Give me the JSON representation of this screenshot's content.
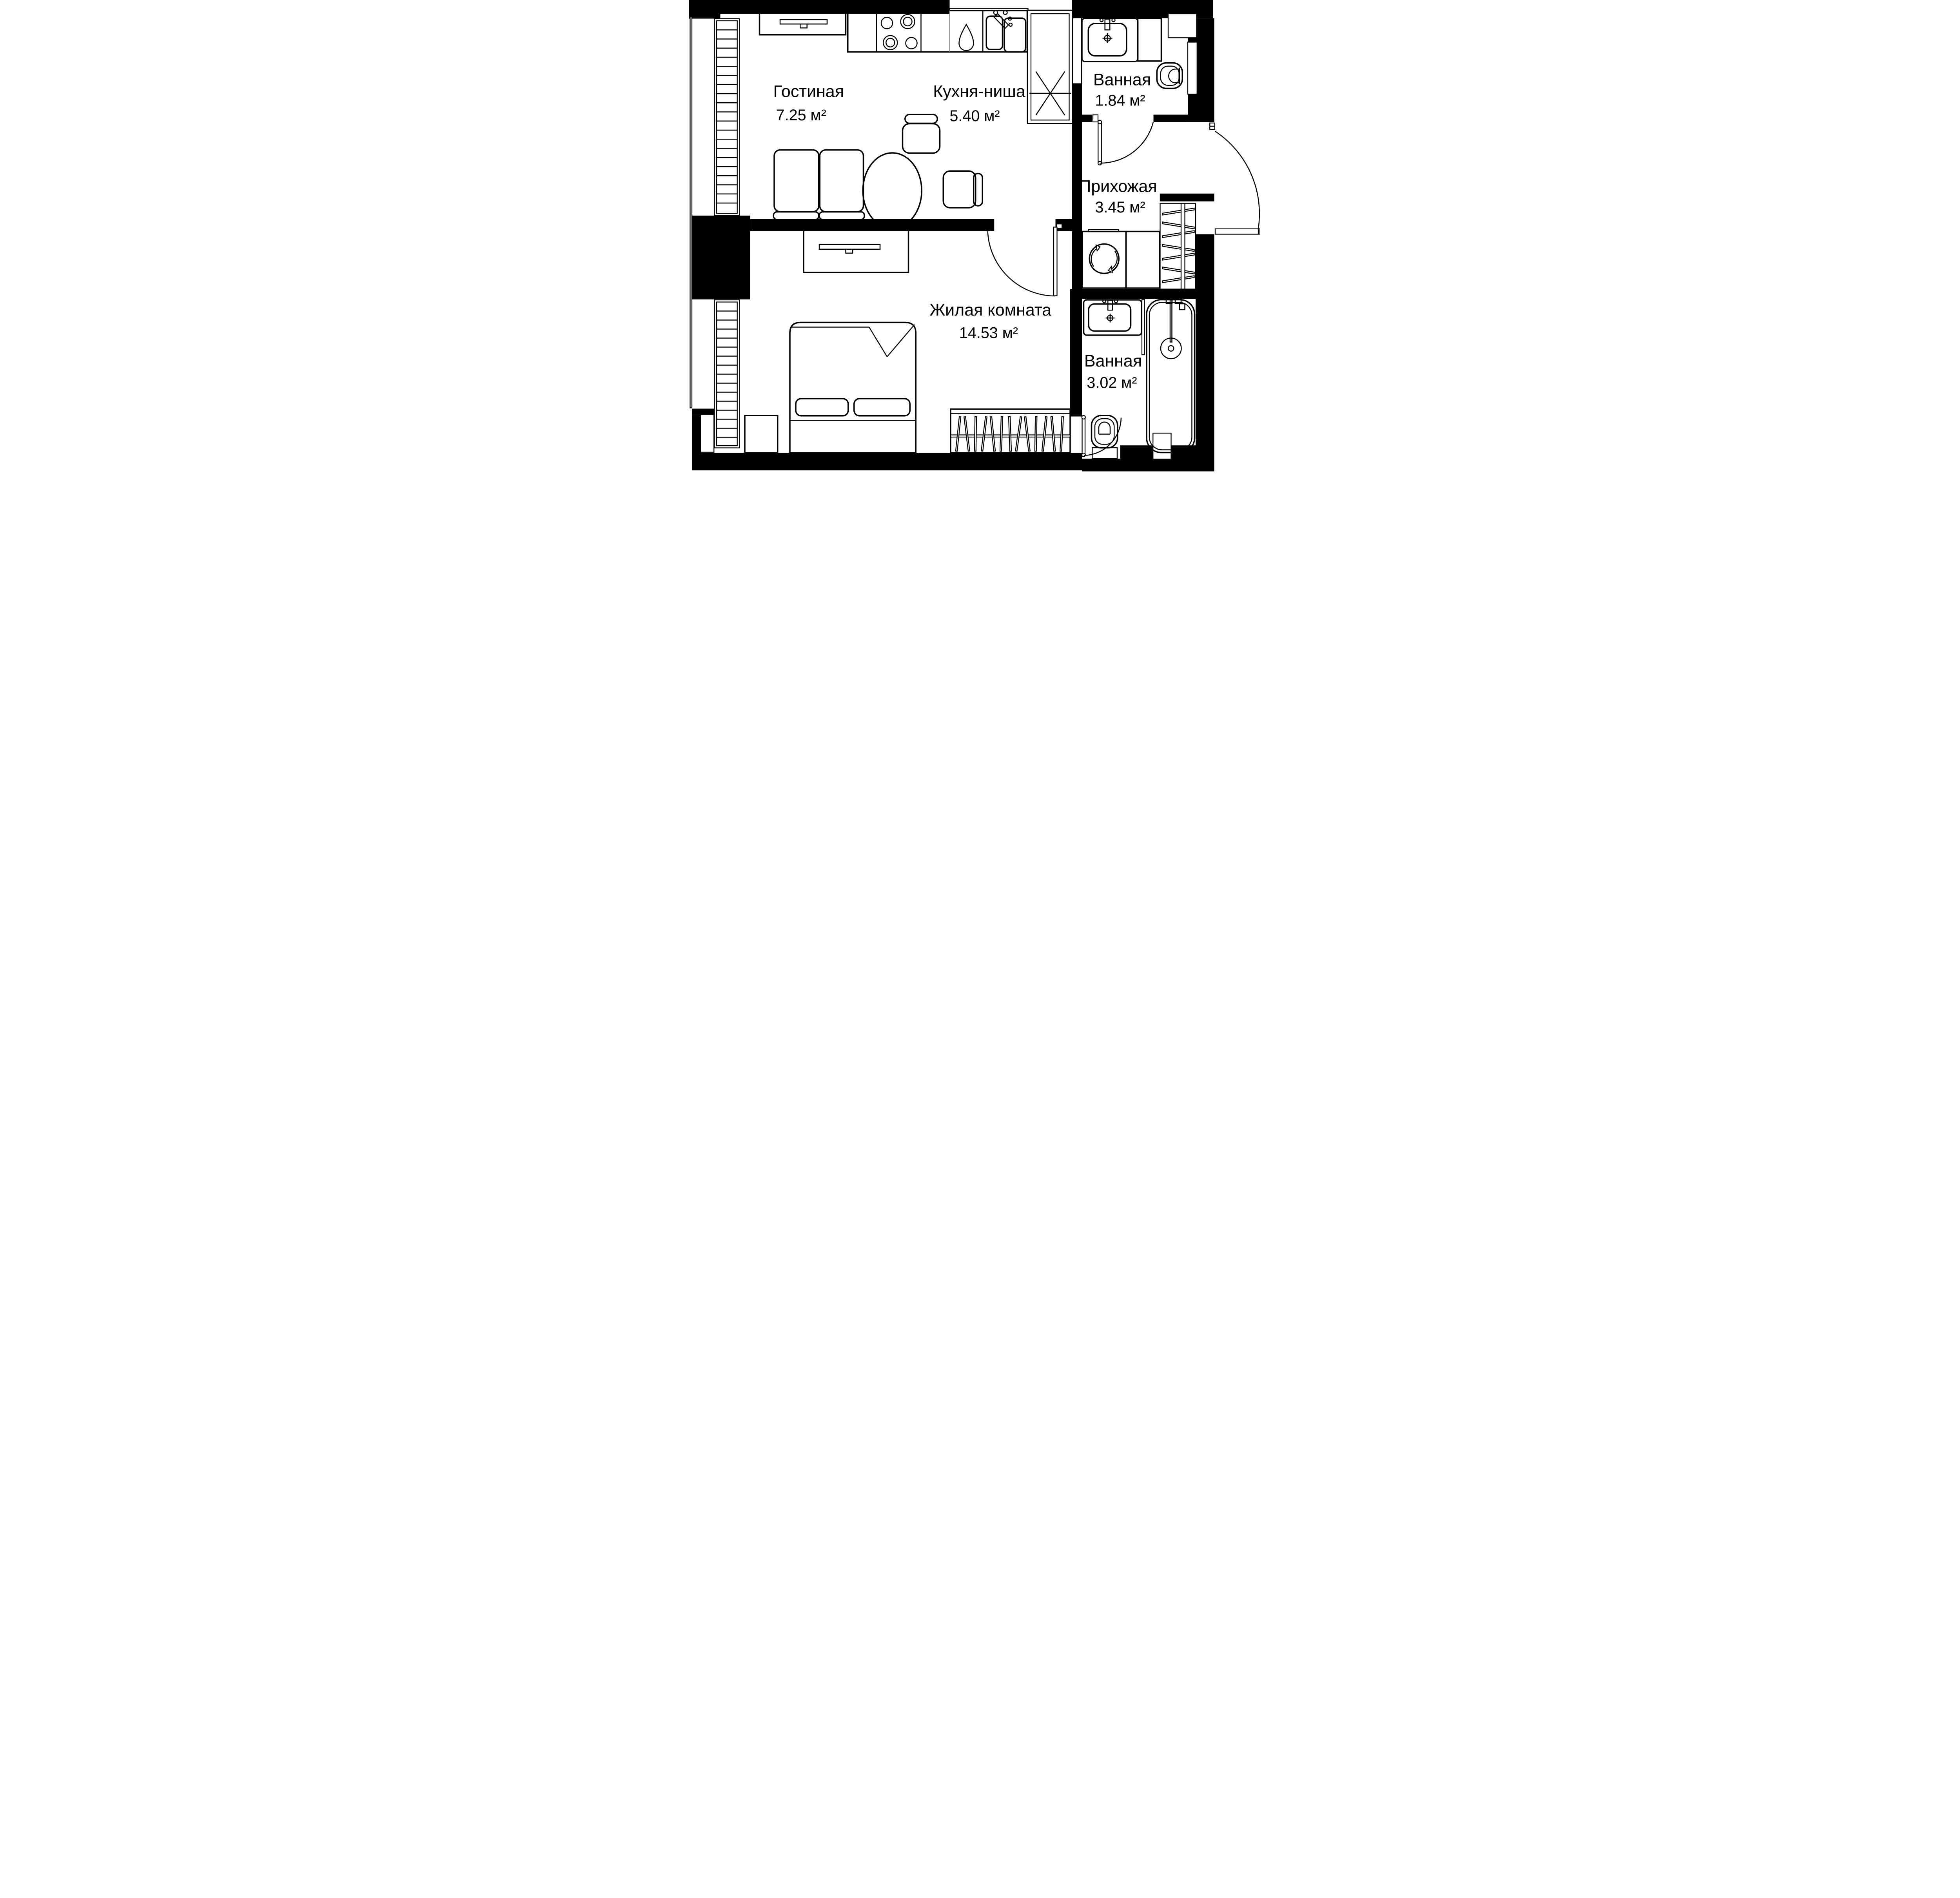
{
  "plan": {
    "title": "Apartment floor plan",
    "rooms": [
      {
        "name": "Гостиная",
        "area": "7.25 м²"
      },
      {
        "name": "Кухня-ниша",
        "area": "5.40 м²"
      },
      {
        "name": "Ванная",
        "area": "1.84 м²"
      },
      {
        "name": "Прихожая",
        "area": "3.45 м²"
      },
      {
        "name": "Жилая комната",
        "area": "14.53 м²"
      },
      {
        "name": "Ванная",
        "area": "3.02 м²"
      }
    ],
    "colors": {
      "walls": "#000000",
      "background": "#ffffff",
      "divider_gray": "#8a8a8a"
    }
  }
}
